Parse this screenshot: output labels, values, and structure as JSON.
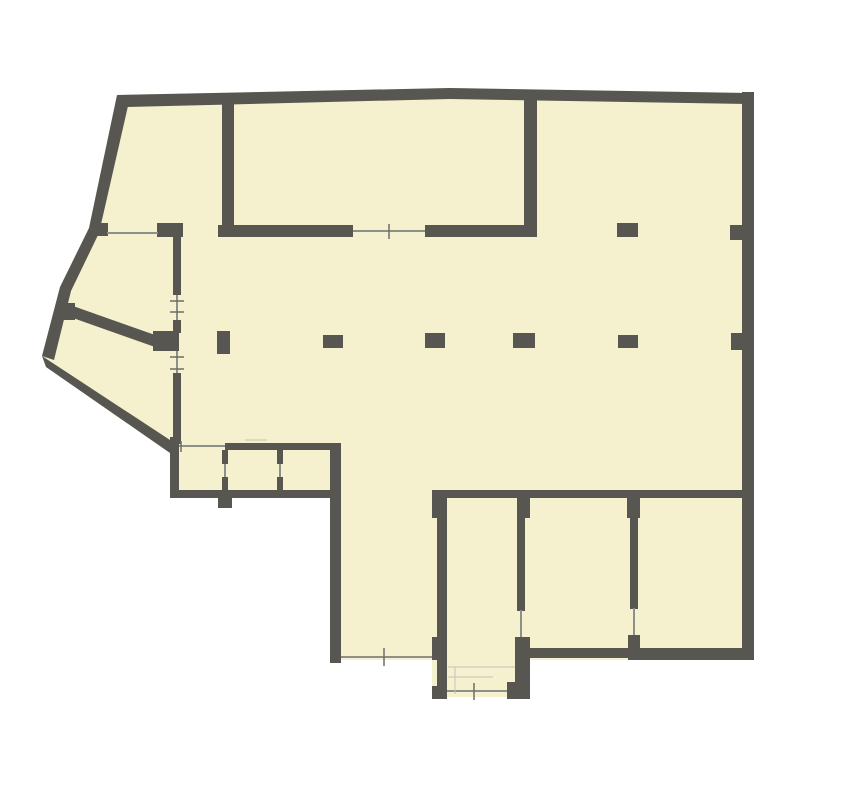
{
  "plan": {
    "canvas": {
      "width": 859,
      "height": 800
    },
    "colors": {
      "background": "#ffffff",
      "floor": "#f5f0cd",
      "wall": "#575651",
      "thin": "#8f8f8a",
      "tick": "#6e6e69",
      "faint": "#c2c2bb"
    },
    "floor_polygon": "117,95 450,88 753,93 753,660 530,660 530,697 432,697 432,660 330,660 330,497 170,497 170,444 42,356 60,287 89,228",
    "walls": {
      "polygons": [
        {
          "name": "top-exterior-wall",
          "points": "117,95 450,88 748,93 748,104 450,99 127,107"
        },
        {
          "name": "left-exterior-wall",
          "points": "117,95 89,228 60,287 42,356 54,360 71,291 99,233 128,106"
        },
        {
          "name": "southwest-exterior-wall",
          "points": "42,356 170,440 170,453 46,367"
        },
        {
          "name": "northwest-diagonal-partition",
          "points": "73,306 155,335 155,347 73,318"
        }
      ],
      "rects": [
        {
          "name": "right-exterior-wall",
          "x": 742,
          "y": 92,
          "w": 12,
          "h": 568
        },
        {
          "name": "southeast-bottom-wall",
          "x": 628,
          "y": 648,
          "w": 126,
          "h": 12
        },
        {
          "name": "room-a-bottom-wall",
          "x": 528,
          "y": 648,
          "w": 102,
          "h": 10
        },
        {
          "name": "stair-bay-bottom-left-block",
          "x": 432,
          "y": 686,
          "w": 15,
          "h": 13
        },
        {
          "name": "stair-bay-bottom-right-block",
          "x": 507,
          "y": 682,
          "w": 23,
          "h": 17
        },
        {
          "name": "stair-bay-west-wall",
          "x": 437,
          "y": 490,
          "w": 10,
          "h": 202
        },
        {
          "name": "stair-bay-west-top-block",
          "x": 432,
          "y": 490,
          "w": 15,
          "h": 28
        },
        {
          "name": "stair-bay-west-mid-block",
          "x": 432,
          "y": 637,
          "w": 15,
          "h": 23
        },
        {
          "name": "stair-bay-east-top-block",
          "x": 517,
          "y": 490,
          "w": 13,
          "h": 28
        },
        {
          "name": "stair-bay-east-wall",
          "x": 517,
          "y": 518,
          "w": 8,
          "h": 93
        },
        {
          "name": "stair-bay-east-bottom-block",
          "x": 515,
          "y": 637,
          "w": 15,
          "h": 62
        },
        {
          "name": "room-divider-east-top-block",
          "x": 627,
          "y": 491,
          "w": 13,
          "h": 27
        },
        {
          "name": "room-divider-east-wall",
          "x": 630,
          "y": 518,
          "w": 8,
          "h": 91
        },
        {
          "name": "room-divider-east-bottom-block",
          "x": 628,
          "y": 635,
          "w": 12,
          "h": 25
        },
        {
          "name": "south-rooms-header-wall",
          "x": 433,
          "y": 490,
          "w": 315,
          "h": 8
        },
        {
          "name": "hall-southwest-wall",
          "x": 330,
          "y": 443,
          "w": 11,
          "h": 220
        },
        {
          "name": "small-rooms-bottom-wall",
          "x": 170,
          "y": 490,
          "w": 171,
          "h": 8
        },
        {
          "name": "small-rooms-bottom-stub",
          "x": 218,
          "y": 497,
          "w": 14,
          "h": 11
        },
        {
          "name": "small-rooms-top-wall",
          "x": 225,
          "y": 443,
          "w": 116,
          "h": 7
        },
        {
          "name": "small-rooms-west-wall",
          "x": 170,
          "y": 437,
          "w": 9,
          "h": 61
        },
        {
          "name": "divider-one-top",
          "x": 222,
          "y": 450,
          "w": 6,
          "h": 14
        },
        {
          "name": "divider-one-bottom",
          "x": 222,
          "y": 477,
          "w": 6,
          "h": 13
        },
        {
          "name": "divider-two-top",
          "x": 277,
          "y": 450,
          "w": 6,
          "h": 14
        },
        {
          "name": "divider-two-bottom",
          "x": 277,
          "y": 477,
          "w": 6,
          "h": 13
        },
        {
          "name": "west-corridor-wall-upper",
          "x": 173,
          "y": 237,
          "w": 8,
          "h": 58
        },
        {
          "name": "west-corridor-wall-mid",
          "x": 173,
          "y": 320,
          "w": 8,
          "h": 13
        },
        {
          "name": "west-corridor-pillar-block",
          "x": 153,
          "y": 331,
          "w": 26,
          "h": 20
        },
        {
          "name": "west-corridor-wall-lower",
          "x": 173,
          "y": 373,
          "w": 8,
          "h": 71
        },
        {
          "name": "north-wall-segment-a",
          "x": 93,
          "y": 223,
          "w": 15,
          "h": 13
        },
        {
          "name": "north-wall-segment-b",
          "x": 157,
          "y": 223,
          "w": 26,
          "h": 14
        },
        {
          "name": "north-wall-segment-c",
          "x": 218,
          "y": 225,
          "w": 135,
          "h": 12
        },
        {
          "name": "north-wall-segment-d",
          "x": 425,
          "y": 225,
          "w": 112,
          "h": 12
        },
        {
          "name": "top-left-room-east-wall",
          "x": 222,
          "y": 100,
          "w": 12,
          "h": 137
        },
        {
          "name": "top-middle-room-east-wall",
          "x": 524,
          "y": 94,
          "w": 13,
          "h": 143
        },
        {
          "name": "left-wall-stub",
          "x": 60,
          "y": 303,
          "w": 15,
          "h": 17
        }
      ]
    },
    "pillars": [
      {
        "name": "pillar-row2-1",
        "x": 217,
        "y": 331,
        "w": 13,
        "h": 23
      },
      {
        "name": "pillar-row2-2",
        "x": 323,
        "y": 335,
        "w": 20,
        "h": 13
      },
      {
        "name": "pillar-row2-3",
        "x": 425,
        "y": 333,
        "w": 20,
        "h": 15
      },
      {
        "name": "pillar-row2-4",
        "x": 513,
        "y": 333,
        "w": 22,
        "h": 15
      },
      {
        "name": "pillar-row2-5",
        "x": 618,
        "y": 335,
        "w": 20,
        "h": 13
      },
      {
        "name": "pillar-row1-1",
        "x": 617,
        "y": 223,
        "w": 21,
        "h": 14
      },
      {
        "name": "right-wall-stub-upper",
        "x": 730,
        "y": 225,
        "w": 18,
        "h": 15
      },
      {
        "name": "right-wall-stub-mid",
        "x": 731,
        "y": 333,
        "w": 19,
        "h": 17
      }
    ],
    "windows": [
      {
        "name": "window-north-left",
        "x1": 107,
        "y1": 233,
        "x2": 158,
        "y2": 233
      },
      {
        "name": "window-north-partition",
        "x1": 353,
        "y1": 231,
        "x2": 425,
        "y2": 231
      },
      {
        "name": "window-west-corridor-upper",
        "x1": 177,
        "y1": 295,
        "x2": 177,
        "y2": 320
      },
      {
        "name": "window-west-corridor-lower",
        "x1": 177,
        "y1": 351,
        "x2": 177,
        "y2": 373
      },
      {
        "name": "window-small-room-one",
        "x1": 179,
        "y1": 446,
        "x2": 225,
        "y2": 446
      },
      {
        "name": "window-south-strip",
        "x1": 341,
        "y1": 657,
        "x2": 432,
        "y2": 657
      },
      {
        "name": "window-stair-bay",
        "x1": 447,
        "y1": 691,
        "x2": 507,
        "y2": 691
      },
      {
        "name": "door-stair-bay-east",
        "x1": 521,
        "y1": 610,
        "x2": 521,
        "y2": 637
      },
      {
        "name": "door-room-divider-east",
        "x1": 634,
        "y1": 608,
        "x2": 634,
        "y2": 635
      },
      {
        "name": "door-divider-one",
        "x1": 225,
        "y1": 464,
        "x2": 225,
        "y2": 477
      },
      {
        "name": "door-divider-two",
        "x1": 280,
        "y1": 464,
        "x2": 280,
        "y2": 477
      }
    ],
    "ticks": [
      {
        "name": "tick-window-north",
        "x1": 389,
        "y1": 224,
        "x2": 389,
        "y2": 239
      },
      {
        "name": "tick-corridor-1",
        "x1": 170,
        "y1": 301,
        "x2": 184,
        "y2": 301
      },
      {
        "name": "tick-corridor-2",
        "x1": 170,
        "y1": 312,
        "x2": 184,
        "y2": 312
      },
      {
        "name": "tick-corridor-3",
        "x1": 170,
        "y1": 357,
        "x2": 184,
        "y2": 357
      },
      {
        "name": "tick-corridor-4",
        "x1": 170,
        "y1": 369,
        "x2": 184,
        "y2": 369
      },
      {
        "name": "tick-south-strip",
        "x1": 384,
        "y1": 648,
        "x2": 384,
        "y2": 666
      },
      {
        "name": "tick-stair-bay",
        "x1": 474,
        "y1": 683,
        "x2": 474,
        "y2": 700
      },
      {
        "name": "tick-small-room-window",
        "x1": 181,
        "y1": 441,
        "x2": 181,
        "y2": 452
      }
    ],
    "faint_lines": [
      {
        "name": "stair-landing-line",
        "x1": 448,
        "y1": 667,
        "x2": 515,
        "y2": 667
      },
      {
        "name": "stair-riser-line",
        "x1": 455,
        "y1": 667,
        "x2": 455,
        "y2": 694
      },
      {
        "name": "stair-step-line",
        "x1": 448,
        "y1": 677,
        "x2": 493,
        "y2": 677
      },
      {
        "name": "small-rooms-dim-line",
        "x1": 245,
        "y1": 440,
        "x2": 267,
        "y2": 440
      }
    ]
  }
}
